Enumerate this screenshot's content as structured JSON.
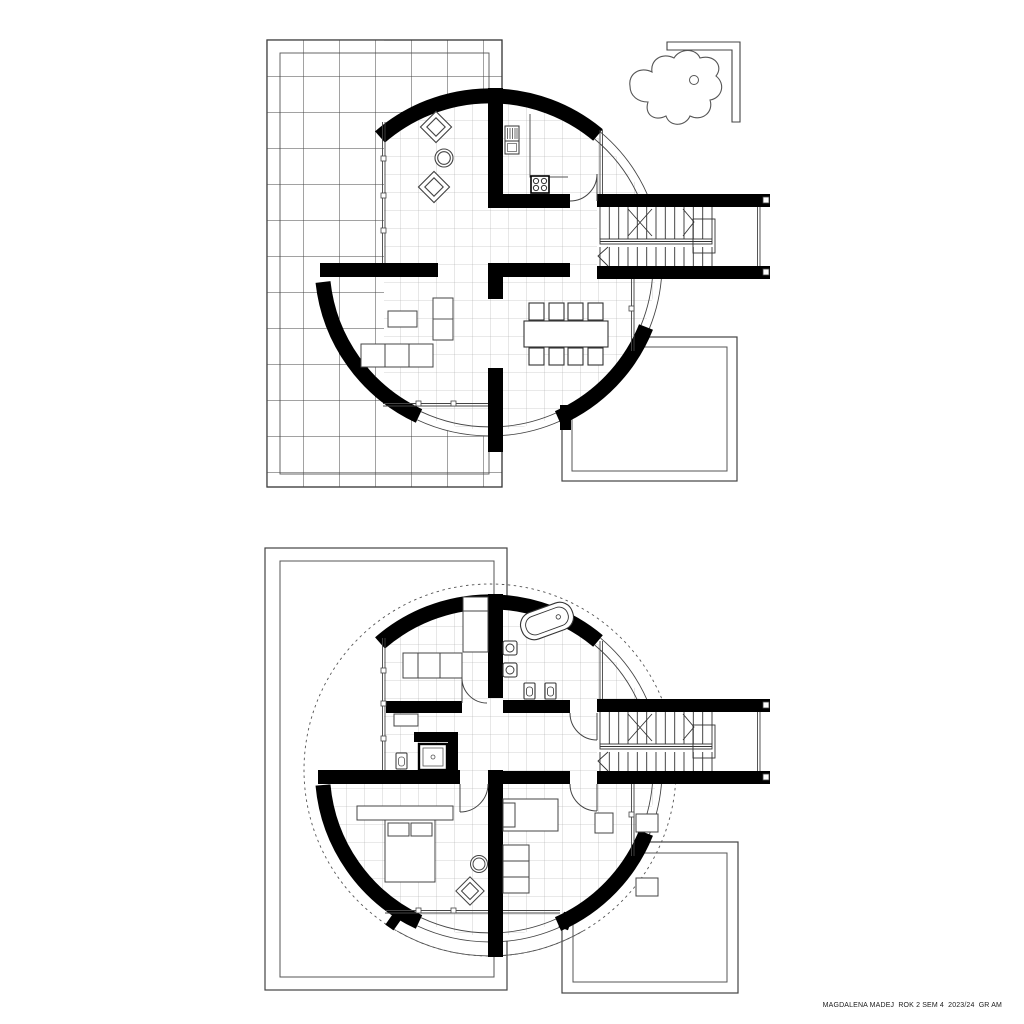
{
  "page": {
    "background": "#ffffff"
  },
  "caption": "MAGDALENA MADEJ  ROK 2 SEM 4  2023/24  GR AM",
  "colors": {
    "wall_ink": "#000000",
    "line": "#444444",
    "grid_major": "#454545",
    "grid_minor": "#a0a0a0",
    "paper": "#ffffff"
  },
  "plans": [
    {
      "name": "ground-floor-plan",
      "features": [
        "terrace-tile-grid",
        "curved-perimeter-walls (4 thick arc segments)",
        "sitting-area: 2 rotated armchairs + round table",
        "kitchen: refrigerator, counter, 4-burner stove, door",
        "dining-table with 8 chairs",
        "living-room: sofa, tv-cabinet, side-unit",
        "stair-corridor: double flight stairs with handrail",
        "garden-pond with stepping stone",
        "l-shaped-garden-wall",
        "southeast-patio (double border)"
      ]
    },
    {
      "name": "upper-floor-plan",
      "features": [
        "dashed-roof-outline-circle",
        "curved-perimeter-walls (arc segments with stubs)",
        "bathroom: tilted bathtub, 2 sinks, toilet, bidet",
        "shower-room: shower cabin, wc",
        "bedroom-northwest: bed + low cabinets",
        "master-bedroom: double bed with headboard, round table, armchair",
        "bedroom-east: bed, dresser, wall units",
        "stair-corridor: double flight stairs with handrail",
        "west-patio (double border)",
        "southeast-patio (double border)"
      ]
    }
  ]
}
